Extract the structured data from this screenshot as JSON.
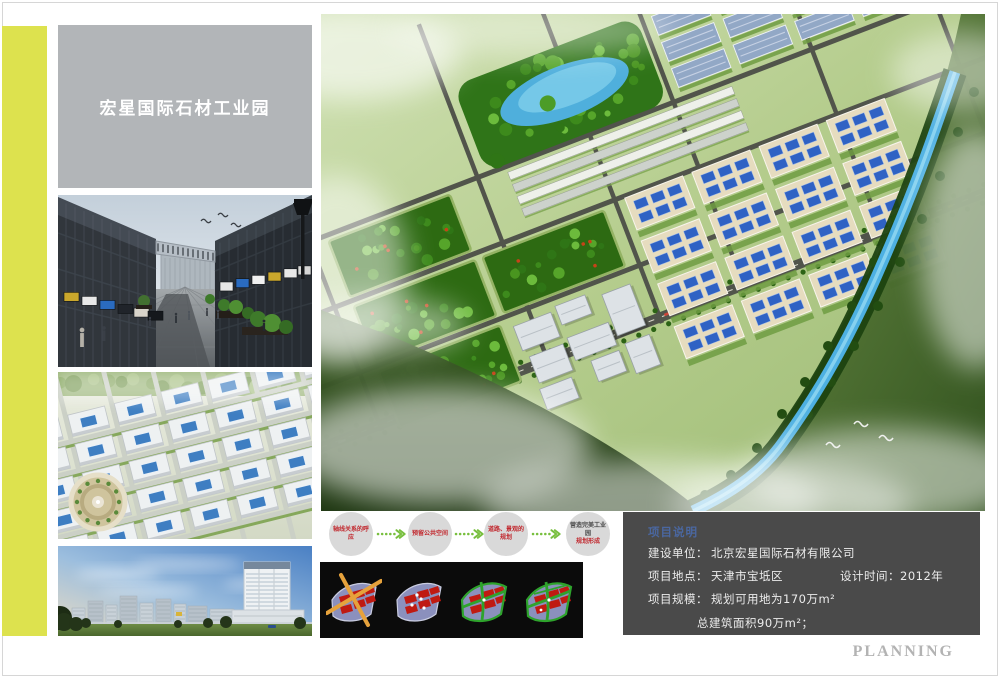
{
  "title_panel": {
    "title": "宏星国际石材工业园"
  },
  "flow": {
    "steps": [
      {
        "label": "轴线关系的呼应"
      },
      {
        "label": "预留公共空间"
      },
      {
        "label": "道路、景观的规划"
      },
      {
        "label": "营造完美工业园",
        "sublabel": "规划形成"
      }
    ]
  },
  "info_panel": {
    "heading": "项目说明",
    "r1_label": "建设单位：",
    "r1_value": "北京宏星国际石材有限公司",
    "r2_label": "项目地点：",
    "r2_value": "天津市宝坻区",
    "r2b_label": "设计时间：",
    "r2b_value": "2012年",
    "r3_label": "项目规模：",
    "r3_value": "规划可用地为170万m²",
    "r4_value": "总建筑面积90万m²；"
  },
  "watermark": "PLANNING",
  "colors": {
    "accent_strip": "#dde24e",
    "title_panel_gray": "#b2b5b8",
    "info_panel_bg": "#4a4a4a",
    "heading_blue": "#4a67a0",
    "flow_arrow_green": "#78bf3e",
    "flow_text_red": "#c1272d",
    "watermark_gray": "#b3b3b3"
  }
}
